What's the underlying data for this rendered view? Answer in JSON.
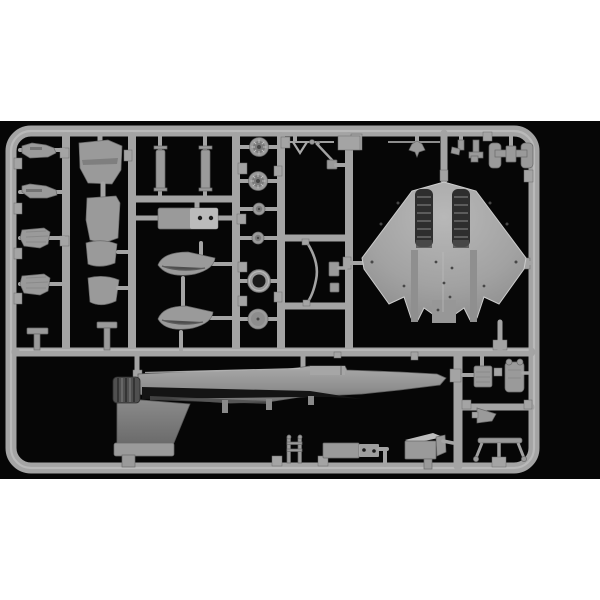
{
  "scene": {
    "type": "photograph",
    "subject": "model-kit-sprue",
    "description": "Photo of a light-gray injection-molded plastic model kit sprue (scale aircraft parts tree) centered on a black background, letterboxed with white bands at the top and bottom of the frame. No text is visible anywhere in the image.",
    "colors": {
      "letterbox": "#ffffff",
      "photo_bg": "#060606",
      "plastic": "#a4a4a4",
      "plastic_hi": "#d2d2d2",
      "plastic_lo": "#6a6a6a",
      "plastic_part": "#9a9a9a",
      "part_dark": "#4e4e4e",
      "channel_dark": "#2e2e2e",
      "groove_dark": "#141414",
      "fin_gray": "#7d7d7d",
      "nozzle_gray": "#4f4f4f"
    },
    "sprue": {
      "frame_shape": "rounded rectangle runner frame",
      "material_look": "matte gray polystyrene with light sheen on runner edges",
      "layout": "grid of vertical and horizontal runners; large lower-fuselage delta-wing piece upper right; full fuselage half lying horizontally across the lower half; columns of small parts on the left"
    },
    "parts": [
      {
        "name": "gear-door-small-1",
        "where": "far-left column, row 1"
      },
      {
        "name": "gear-door-small-2",
        "where": "far-left column, row 2"
      },
      {
        "name": "finned-fairing-1",
        "where": "far-left column, row 3"
      },
      {
        "name": "finned-fairing-2",
        "where": "far-left column, row 4"
      },
      {
        "name": "t-bracket-small",
        "where": "far-left column, bottom"
      },
      {
        "name": "intake-ramp-panel-large",
        "where": "second column, top"
      },
      {
        "name": "intake-ramp-panel-small",
        "where": "second column, middle"
      },
      {
        "name": "intake-lip-upper",
        "where": "second column"
      },
      {
        "name": "intake-lip-lower",
        "where": "second column"
      },
      {
        "name": "t-bracket-2",
        "where": "second column, bottom"
      },
      {
        "name": "slender-store-left",
        "where": "third cell, vertical slender part"
      },
      {
        "name": "slender-store-right",
        "where": "third cell, vertical slender part"
      },
      {
        "name": "equipment-box-two-holes",
        "where": "third cell, below stores"
      },
      {
        "name": "canopy-half-upper",
        "where": "third cell, lower area"
      },
      {
        "name": "canopy-half-lower",
        "where": "third cell, lower area"
      },
      {
        "name": "main-wheel-ribbed-1",
        "where": "wheel column"
      },
      {
        "name": "main-wheel-ribbed-2",
        "where": "wheel column"
      },
      {
        "name": "small-wheel-1",
        "where": "wheel column"
      },
      {
        "name": "small-wheel-2",
        "where": "wheel column"
      },
      {
        "name": "engine-ring",
        "where": "wheel column"
      },
      {
        "name": "exhaust-disc",
        "where": "wheel column, bottom"
      },
      {
        "name": "v-antenna-linkage",
        "where": "linkage cell, top"
      },
      {
        "name": "diagonal-actuator-rod",
        "where": "linkage cell, top"
      },
      {
        "name": "curved-gear-strut",
        "where": "linkage cell, bottom"
      },
      {
        "name": "square-blank-pad",
        "where": "top rail, center"
      },
      {
        "name": "pitot-anchor-part",
        "where": "top rail, right of center"
      },
      {
        "name": "hook-bracket",
        "where": "top rail, right"
      },
      {
        "name": "l-bracket",
        "where": "top rail, right"
      },
      {
        "name": "wheel-chock-h-assembly",
        "where": "top-right corner cell"
      },
      {
        "name": "lower-fuselage-delta-wing-piece",
        "where": "large piece, right-center, intake channels visible"
      },
      {
        "name": "fuselage-half-with-fin-and-nozzle",
        "where": "long piece across lower half, nose pointing right, fin down"
      },
      {
        "name": "boarding-ladder",
        "where": "bottom rail, center-left"
      },
      {
        "name": "pylon-box",
        "where": "bottom rail, center"
      },
      {
        "name": "equipment-scoop-box",
        "where": "bottom rail, center-right"
      },
      {
        "name": "ribbed-seat-block",
        "where": "bottom-right cell"
      },
      {
        "name": "seat-back-part",
        "where": "bottom-right cell"
      },
      {
        "name": "rudder-triangle-part",
        "where": "bottom-right cell"
      },
      {
        "name": "landing-gear-bogey",
        "where": "bottom-right cell, on bottom rail"
      }
    ]
  }
}
